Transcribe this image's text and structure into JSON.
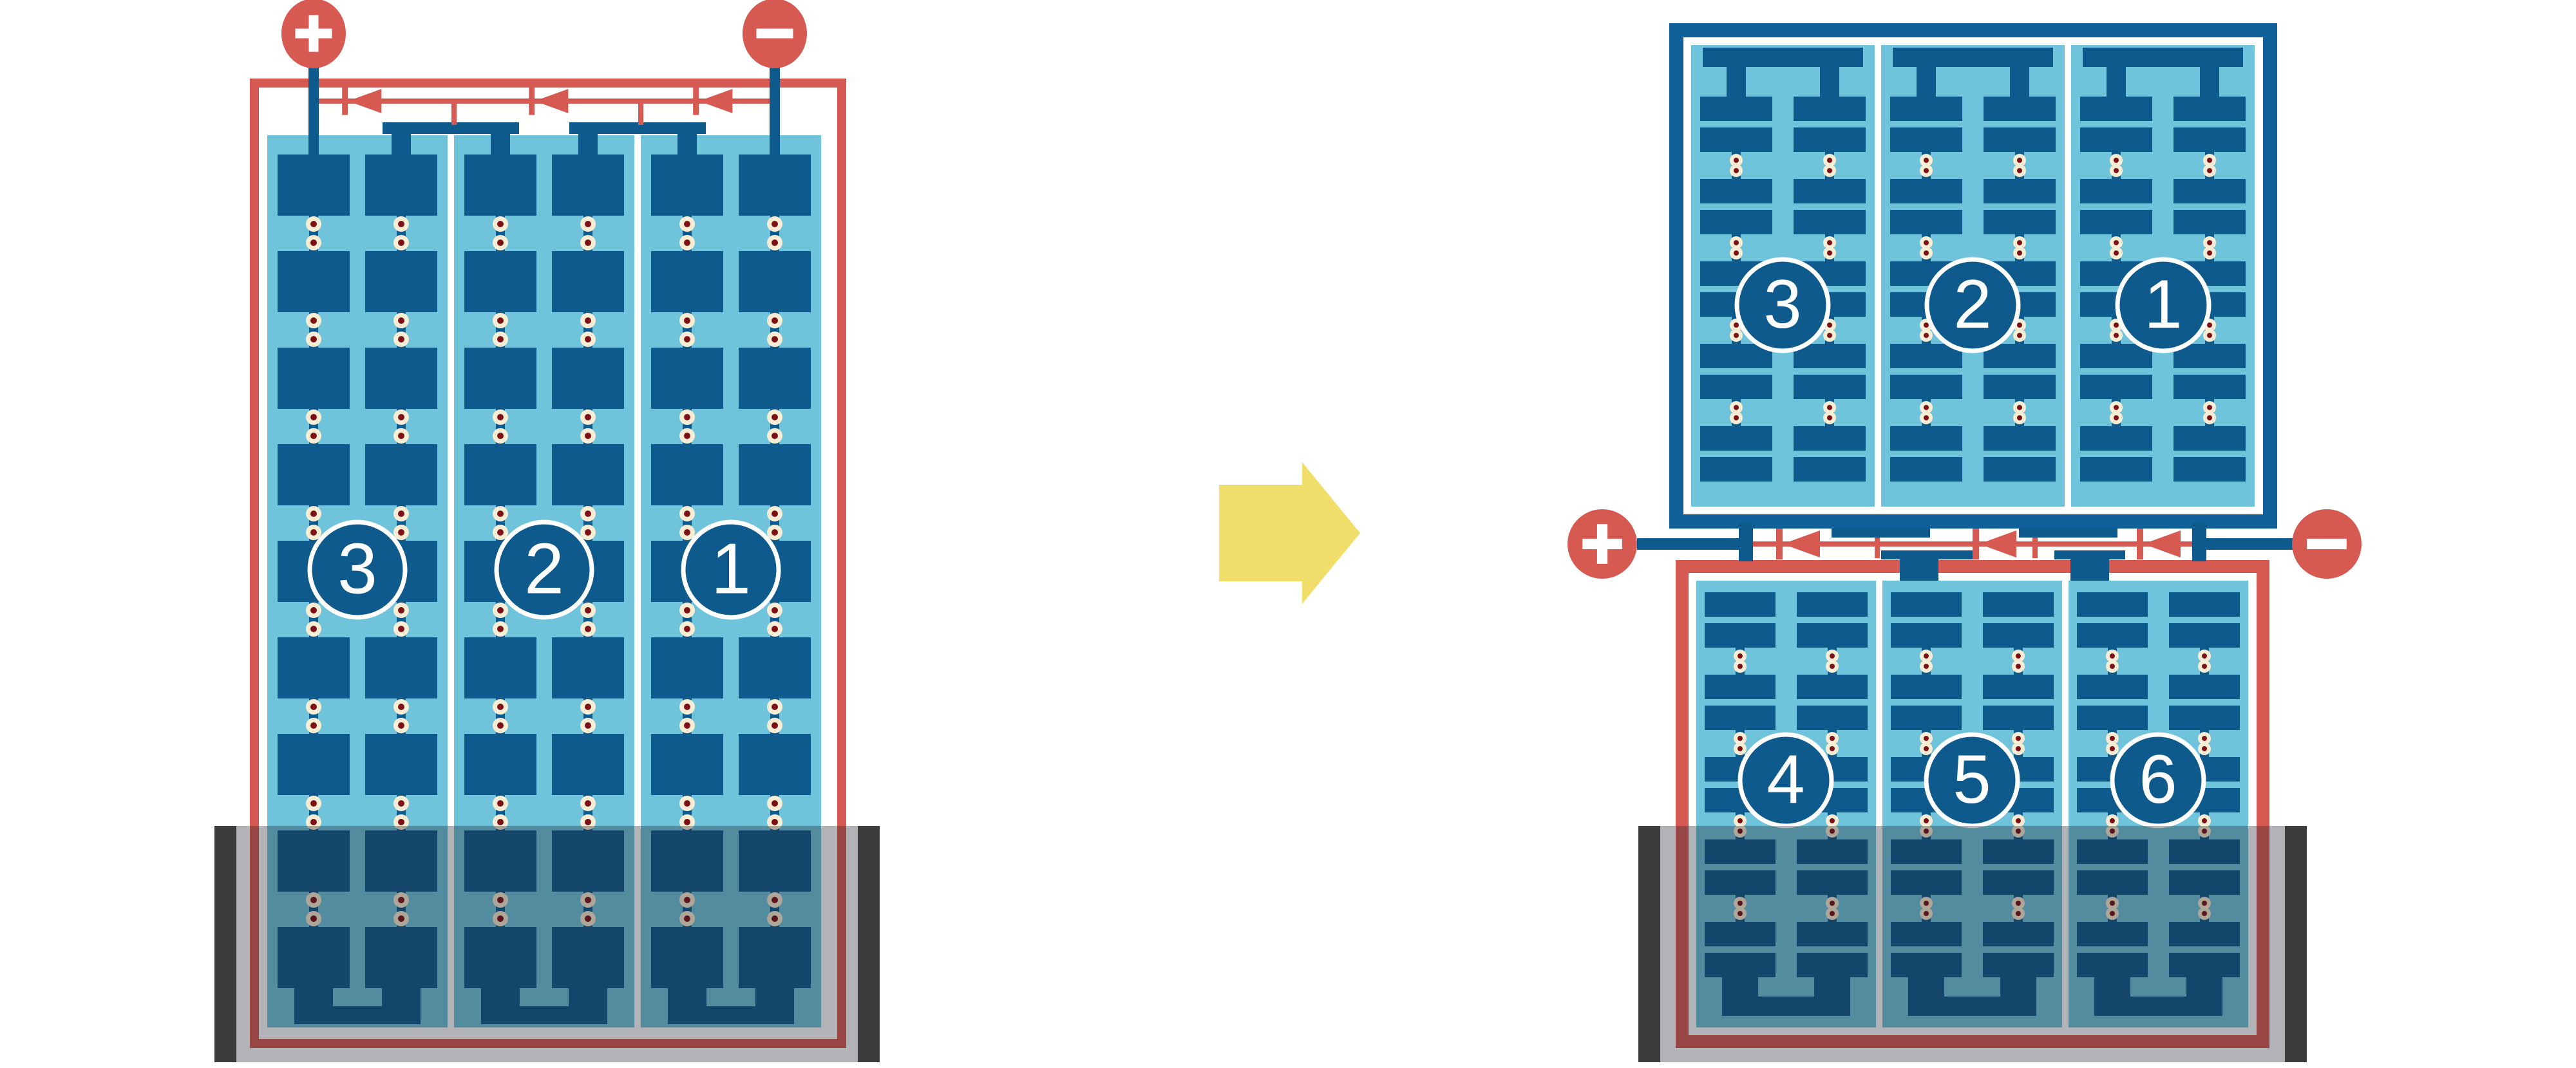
{
  "colors": {
    "background": "#ffffff",
    "panel_blue": "#6fc4dc",
    "cell_navy": "#0e5a8c",
    "frame_navy": "#11609a",
    "frame_red": "#d75a52",
    "terminal_red": "#d75a52",
    "diode_red": "#d75a52",
    "solder_cream": "#f7ecd4",
    "solder_maroon": "#7c1215",
    "arrow_yellow": "#f0dd6a",
    "shade_bar_black": "#3b3b3b",
    "shade_overlay": "rgba(28,32,42,0.34)",
    "label_white": "#ffffff"
  },
  "left_module": {
    "positive_sign": "+",
    "negative_sign": "−",
    "bypass_diode_count": 3,
    "strings": [
      {
        "label": "3"
      },
      {
        "label": "2"
      },
      {
        "label": "1"
      }
    ]
  },
  "right_top_module": {
    "strings": [
      {
        "label": "3"
      },
      {
        "label": "2"
      },
      {
        "label": "1"
      }
    ]
  },
  "right_bottom_module": {
    "strings": [
      {
        "label": "4"
      },
      {
        "label": "5"
      },
      {
        "label": "6"
      }
    ]
  },
  "junction": {
    "positive_sign": "+",
    "negative_sign": "−",
    "bypass_diode_count": 3
  }
}
